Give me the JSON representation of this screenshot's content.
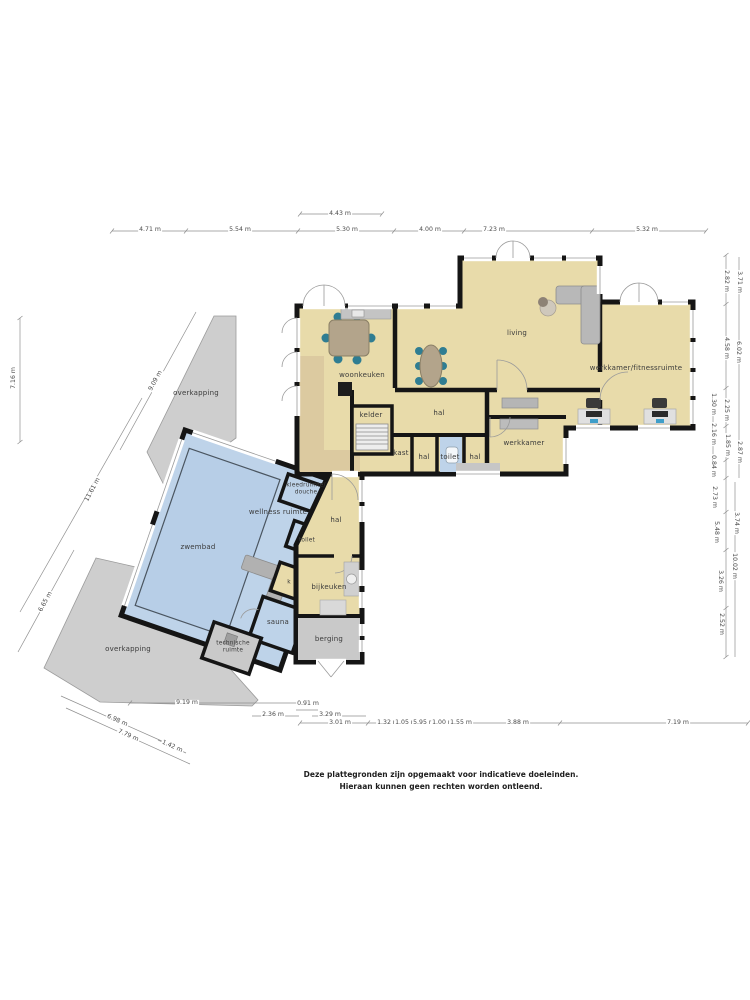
{
  "document": {
    "disclaimer_line1": "Deze plattegronden zijn opgemaakt voor indicatieve doeleinden.",
    "disclaimer_line2": "Hieraan kunnen geen rechten worden ontleend."
  },
  "colors": {
    "wall": "#151515",
    "room_fill": "#e8dbaa",
    "pool_fill": "#bed3e9",
    "pool_water": "#b7cee7",
    "covered_fill": "#cecece",
    "storage_fill": "#c9c9c9",
    "chair_accent": "#2f7d92",
    "furniture_gray": "#b5b5b5"
  },
  "floorplan": {
    "room_labels": [
      {
        "id": "woonkeuken",
        "text": "woonkeuken",
        "x": 362,
        "y": 375
      },
      {
        "id": "living",
        "text": "living",
        "x": 517,
        "y": 333
      },
      {
        "id": "werkkamer-fitnessruimte",
        "text": "werkkamer/fitnessruimte",
        "x": 636,
        "y": 368
      },
      {
        "id": "hal-main",
        "text": "hal",
        "x": 439,
        "y": 413
      },
      {
        "id": "kelder",
        "text": "kelder",
        "x": 371,
        "y": 415
      },
      {
        "id": "kast",
        "text": "kast",
        "x": 401,
        "y": 453
      },
      {
        "id": "hal-small-1",
        "text": "hal",
        "x": 424,
        "y": 457
      },
      {
        "id": "toilet-main",
        "text": "toilet",
        "x": 450,
        "y": 457
      },
      {
        "id": "hal-small-2",
        "text": "hal",
        "x": 475,
        "y": 457
      },
      {
        "id": "werkkamer",
        "text": "werkkamer",
        "x": 524,
        "y": 443
      },
      {
        "id": "zwembad",
        "text": "zwembad",
        "x": 198,
        "y": 547
      },
      {
        "id": "wellness-ruimte",
        "text": "wellness ruimte",
        "x": 278,
        "y": 512
      },
      {
        "id": "kleedruimte-douche",
        "text": "kleedruimte/\ndouche",
        "x": 306,
        "y": 489,
        "small": true
      },
      {
        "id": "toilet-pool",
        "text": "toilet",
        "x": 307,
        "y": 541,
        "small": true
      },
      {
        "id": "hal-lower",
        "text": "hal",
        "x": 336,
        "y": 520
      },
      {
        "id": "k",
        "text": "k",
        "x": 289,
        "y": 583,
        "small": true
      },
      {
        "id": "sauna",
        "text": "sauna",
        "x": 278,
        "y": 622
      },
      {
        "id": "technische-ruimte",
        "text": "technische\nruimte",
        "x": 233,
        "y": 647,
        "small": true
      },
      {
        "id": "bijkeuken",
        "text": "bijkeuken",
        "x": 329,
        "y": 587
      },
      {
        "id": "berging",
        "text": "berging",
        "x": 329,
        "y": 639
      },
      {
        "id": "overkapping-top",
        "text": "overkapping",
        "x": 196,
        "y": 393
      },
      {
        "id": "overkapping-bottom",
        "text": "overkapping",
        "x": 128,
        "y": 649
      }
    ],
    "dimension_labels": [
      {
        "id": "dim-4-43",
        "text": "4.43 m",
        "x": 340,
        "y": 214
      },
      {
        "id": "dim-4-71",
        "text": "4.71 m",
        "x": 150,
        "y": 230
      },
      {
        "id": "dim-5-54",
        "text": "5.54 m",
        "x": 240,
        "y": 230
      },
      {
        "id": "dim-5-30",
        "text": "5.30 m",
        "x": 347,
        "y": 230
      },
      {
        "id": "dim-4-00",
        "text": "4.00 m",
        "x": 430,
        "y": 230
      },
      {
        "id": "dim-7-23",
        "text": "7.23 m",
        "x": 494,
        "y": 230
      },
      {
        "id": "dim-5-32",
        "text": "5.32 m",
        "x": 647,
        "y": 230
      },
      {
        "id": "dim-7-16",
        "text": "7.16 m",
        "x": 14,
        "y": 378,
        "rotate": -90
      },
      {
        "id": "dim-9-09",
        "text": "9.09 m",
        "x": 156,
        "y": 381,
        "rotate": -62
      },
      {
        "id": "dim-11-61",
        "text": "11.61 m",
        "x": 93,
        "y": 490,
        "rotate": -62
      },
      {
        "id": "dim-6-65",
        "text": "6.65 m",
        "x": 46,
        "y": 602,
        "rotate": -62
      },
      {
        "id": "dim-9-19",
        "text": "9.19 m",
        "x": 187,
        "y": 703
      },
      {
        "id": "dim-0-91",
        "text": "0.91 m",
        "x": 308,
        "y": 704
      },
      {
        "id": "dim-2-36",
        "text": "2.36 m",
        "x": 273,
        "y": 715
      },
      {
        "id": "dim-3-29",
        "text": "3.29 m",
        "x": 330,
        "y": 715
      },
      {
        "id": "dim-3-01",
        "text": "3.01 m",
        "x": 340,
        "y": 723
      },
      {
        "id": "dim-1-32",
        "text": "1.32 m",
        "x": 388,
        "y": 723
      },
      {
        "id": "dim-1-05",
        "text": "1.05 m",
        "x": 406,
        "y": 723
      },
      {
        "id": "dim-5-95",
        "text": "5.95 m",
        "x": 424,
        "y": 723
      },
      {
        "id": "dim-1-00",
        "text": "1.00 m",
        "x": 443,
        "y": 723
      },
      {
        "id": "dim-1-55",
        "text": "1.55 m",
        "x": 461,
        "y": 723
      },
      {
        "id": "dim-3-88",
        "text": "3.88 m",
        "x": 518,
        "y": 723
      },
      {
        "id": "dim-7-19",
        "text": "7.19 m",
        "x": 678,
        "y": 723
      },
      {
        "id": "dim-6-98",
        "text": "6.98 m",
        "x": 117,
        "y": 721,
        "rotate": 24
      },
      {
        "id": "dim-7-79",
        "text": "7.79 m",
        "x": 128,
        "y": 736,
        "rotate": 24
      },
      {
        "id": "dim-1-42",
        "text": "1.42 m",
        "x": 172,
        "y": 747,
        "rotate": 24
      },
      {
        "id": "dim-2-82",
        "text": "2.82 m",
        "x": 726,
        "y": 281,
        "rotate": 90
      },
      {
        "id": "dim-3-71",
        "text": "3.71 m",
        "x": 739,
        "y": 282,
        "rotate": 90
      },
      {
        "id": "dim-4-58",
        "text": "4.58 m",
        "x": 726,
        "y": 348,
        "rotate": 90
      },
      {
        "id": "dim-6-02",
        "text": "6.02 m",
        "x": 738,
        "y": 352,
        "rotate": 90
      },
      {
        "id": "dim-1-30",
        "text": "1.30 m",
        "x": 713,
        "y": 404,
        "rotate": 90
      },
      {
        "id": "dim-2-25",
        "text": "2.25 m",
        "x": 726,
        "y": 410,
        "rotate": 90
      },
      {
        "id": "dim-2-16",
        "text": "2.16 m",
        "x": 713,
        "y": 434,
        "rotate": 90
      },
      {
        "id": "dim-1-85",
        "text": "1.85 m",
        "x": 727,
        "y": 445,
        "rotate": 90
      },
      {
        "id": "dim-2-87",
        "text": "2.87 m",
        "x": 739,
        "y": 452,
        "rotate": 90
      },
      {
        "id": "dim-0-84",
        "text": "0.84 m",
        "x": 713,
        "y": 466,
        "rotate": 90
      },
      {
        "id": "dim-2-73",
        "text": "2.73 m",
        "x": 714,
        "y": 497,
        "rotate": 90
      },
      {
        "id": "dim-3-74",
        "text": "3.74 m",
        "x": 736,
        "y": 523,
        "rotate": 90
      },
      {
        "id": "dim-5-48",
        "text": "5.48 m",
        "x": 716,
        "y": 532,
        "rotate": 90
      },
      {
        "id": "dim-10-02",
        "text": "10.02 m",
        "x": 734,
        "y": 566,
        "rotate": 90
      },
      {
        "id": "dim-3-26",
        "text": "3.26 m",
        "x": 720,
        "y": 581,
        "rotate": 90
      },
      {
        "id": "dim-2-52",
        "text": "2.52 m",
        "x": 721,
        "y": 624,
        "rotate": 90
      }
    ]
  }
}
